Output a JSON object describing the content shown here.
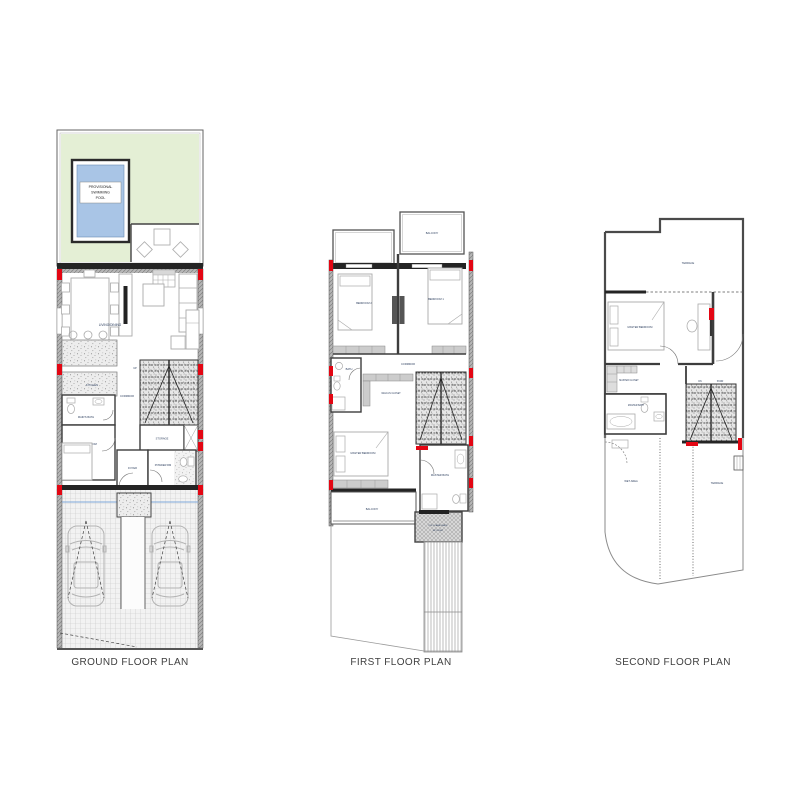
{
  "document": {
    "background": "#ffffff"
  },
  "colors": {
    "wall_dark": "#242424",
    "wall_gray": "#8c8c8c",
    "marker_red": "#e30613",
    "garden_green": "#e4efd5",
    "pool_blue": "#a9c5e6",
    "driveway_water_line": "#7fa8d9",
    "label_text": "#2f4160",
    "title_text": "#3f3f3f"
  },
  "plans": {
    "ground": {
      "title": "GROUND FLOOR PLAN",
      "labels": {
        "pool_line1": "PROVISIONAL",
        "pool_line2": "SWIMMING",
        "pool_line3": "POOL",
        "living_dining": "LIVING/DINING",
        "kitchen": "KITCHEN",
        "corridor": "CORRIDOR",
        "maids_bath": "MAID'S BATH",
        "maids_room": "MAID'S ROOM",
        "maids_room_area": "7.5 m²",
        "up": "UP",
        "storage": "STORAGE",
        "foyer": "FOYER",
        "powder_room": "POWDER RM"
      }
    },
    "first": {
      "title": "FIRST FLOOR PLAN",
      "labels": {
        "balcony_top": "BALCONY",
        "bedroom_2": "BEDROOM 2",
        "bedroom_1": "BEDROOM 1",
        "corridor": "CORRIDOR",
        "bath": "BATH",
        "walk_in_closet": "WALK-IN CLOSET",
        "master_bedroom": "MASTER BEDROOM",
        "master_bath": "MASTER BATH",
        "balcony_bottom": "BALCONY",
        "skylight_line1": "POLYCARBONATE",
        "skylight_line2": "SKYLIGHT"
      }
    },
    "second": {
      "title": "SECOND FLOOR PLAN",
      "labels": {
        "terrace_top": "TERRACE",
        "master_bedroom": "MASTER BEDROOM",
        "master_closet": "MASTER CLOSET",
        "master_bath": "MASTER BATH",
        "dn": "DN",
        "stair": "STAIR",
        "wet_area": "WET AREA",
        "terrace_bottom": "TERRACE"
      }
    }
  }
}
